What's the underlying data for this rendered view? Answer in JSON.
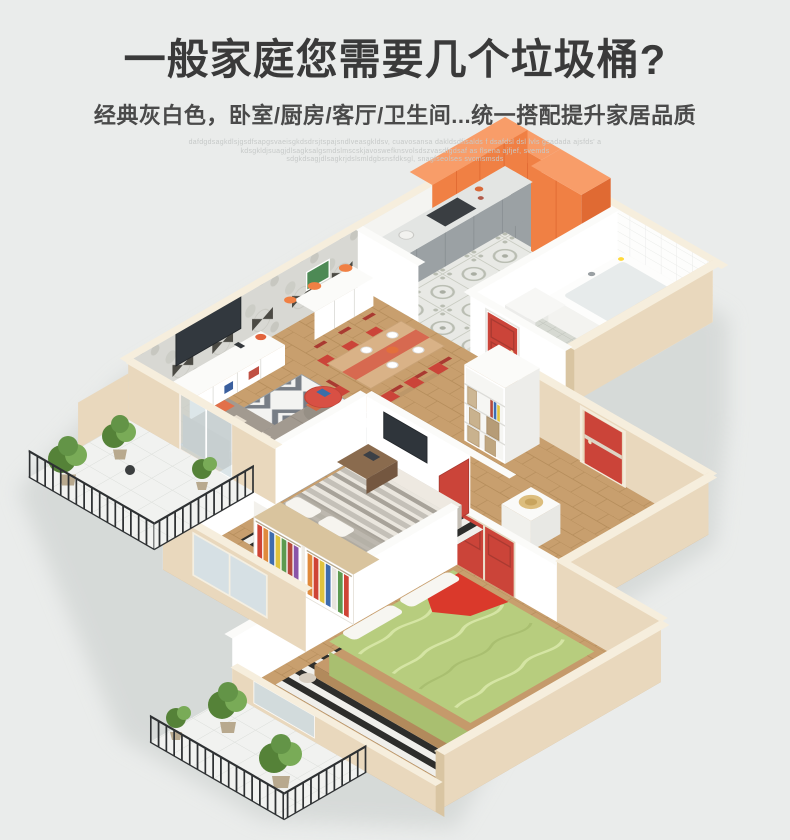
{
  "header": {
    "title": "一般家庭您需要几个垃圾桶?",
    "subtitle": "经典灰白色，卧室/厨房/客厅/卫生间...统一搭配提升家居品质"
  },
  "watermark": {
    "lines": [
      "dafdgdsagkdlsjgsdfsapgsvaeisgkdsdrsjtspajsndlveasgkldsv, cuavosansa dakldsdfisalds f dsafdsl dsl lvls gsadada ajsfds' a",
      "kdsgkldjsuagjdlsagksalgsmdslmscskjavoswefknsvolsdszvasdfgdsaf as flsena ajfjef, svemds",
      "sdgkdsagjdlsagkrjdslsmldgbsnsfdksgl, snagfseolses svcmsmsds"
    ]
  },
  "colors": {
    "bg": "#eaeceb",
    "title": "#3a3a3a",
    "subtitle": "#4a4a4a",
    "watermark": "#c6c9c8",
    "orange": "#f08044",
    "orangeLight": "#f89d69",
    "orangeDark": "#e06a33",
    "red": "#cb4439",
    "redDark": "#a93a31",
    "cream": "#e9d8bd",
    "creamLight": "#f6eedd",
    "creamDark": "#d9c5a2",
    "wood": "#c89f6e",
    "woodLine": "#b68e5c",
    "green": "#b7cd7e",
    "greenDark": "#a9bf70",
    "greenLight": "#d5e5a4",
    "sofa": "#a29a90",
    "sofaDark": "#948c82",
    "rail": "#2e3133",
    "plant": "#558238",
    "plantLight": "#79ab57",
    "shadow": "#d2d6d4",
    "wallWhite": "#ffffff",
    "wallShade": "#f0f0ec"
  }
}
